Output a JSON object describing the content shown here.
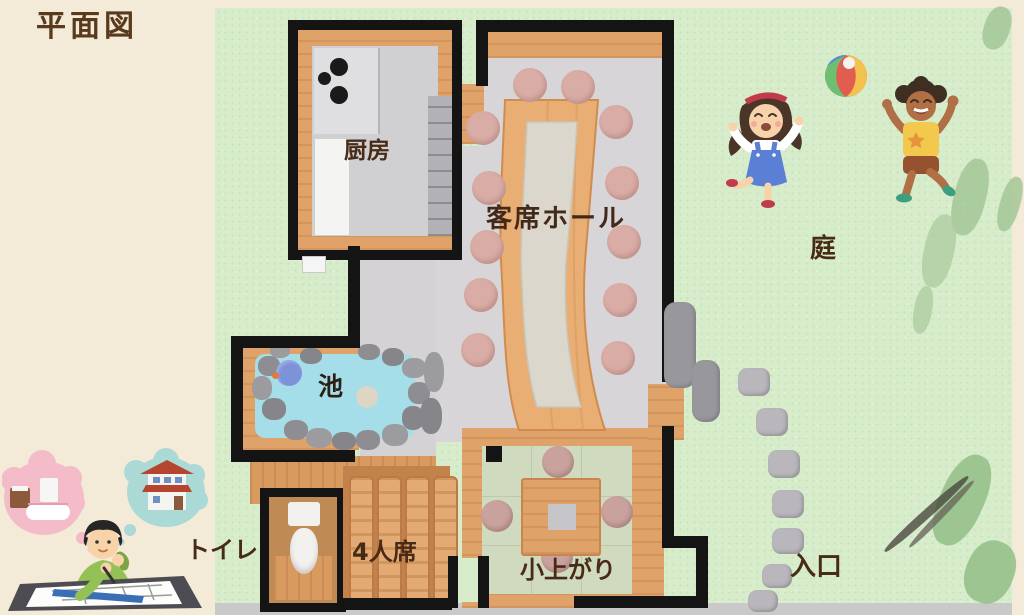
{
  "title": "平面図",
  "rooms": {
    "kitchen": "厨房",
    "hall": "客席ホール",
    "garden": "庭",
    "pond": "池",
    "toilet": "トイレ",
    "four_seat_booth": "4人席",
    "tatami_area": "小上がり",
    "entrance": "入口"
  },
  "icons": {
    "beach_ball": "beach-ball-icon",
    "girl": "girl-playing-illustration",
    "boy": "boy-playing-illustration",
    "architect": "architect-drawing-plan-illustration",
    "thought_bubbles": [
      "bathroom-thought-bubble",
      "house-thought-bubble"
    ]
  },
  "colors": {
    "sidebar_bg": "#f4ead8",
    "garden_green": "#d7ecca",
    "wall_black": "#141414",
    "wood": "#dfa268",
    "wood_dark": "#c2824c",
    "floor_gray": "#d7d5d7",
    "pond_blue": "#a5dde8",
    "tatami_green": "#cfdabe",
    "stool_pink": "#d9aca6",
    "stone_gray": "#b9b7bc",
    "label_brown": "#472b17"
  }
}
